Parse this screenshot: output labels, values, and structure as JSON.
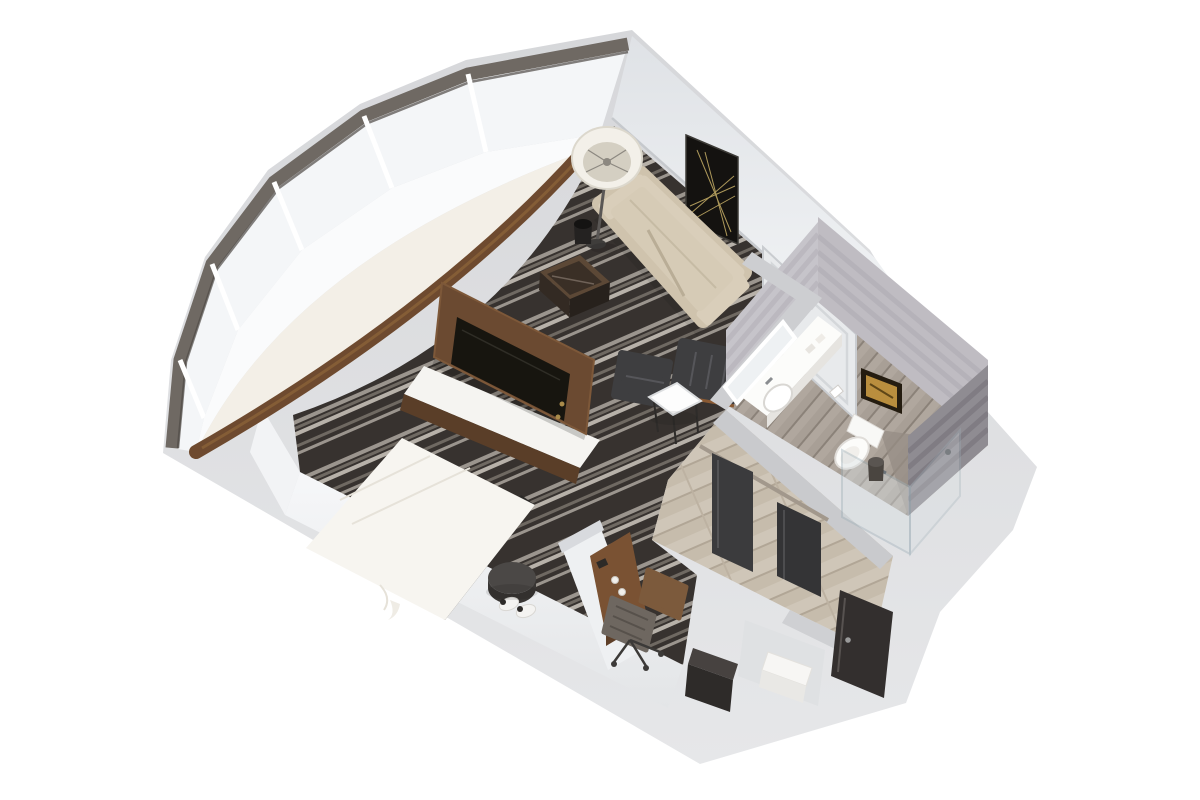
{
  "meta": {
    "type": "3d-floorplan-render",
    "view": "isometric-cutaway-dollhouse",
    "description": "3D cutaway floor plan render of a hotel studio suite with a curved faceted window wall, striped carpet, king bed, leaning TV media panel, beige sofa, lounge chair, work desk, entry hallway with closet, and a bathroom with vanity, toilet and glass shower."
  },
  "palette": {
    "background": "#ffffff",
    "wall_top": "#d3d4d7",
    "wall_top_dark": "#c6c7cb",
    "wall_inner": "#e9ebee",
    "wall_inner_bright": "#f4f5f7",
    "baseboard_shadow": "#c6c9cd",
    "glass": "#f4f6f8",
    "transom": "#6f6963",
    "mullion": "#ffffff",
    "sill_wall": "#fafbfc",
    "carpet_base": "#37322f",
    "carpet_stripe_light": "#9b958e",
    "carpet_stripe_mid": "#6f6962",
    "carpet_stripe_pale": "#b7b1a9",
    "bench_wood": "#6e4a2f",
    "bench_cushion": "#f3efe7",
    "bed_linen": "#f7f5f0",
    "bed_platform": "#2c2a28",
    "stool_dark": "#4b4846",
    "slipper_white": "#f4f3f1",
    "tv_wood": "#6b4a31",
    "tv_screen": "#17150f",
    "console_top": "#f5f4f1",
    "console_base": "#5a3e28",
    "cube_top": "#3a2f26",
    "cube_wood": "#5c4836",
    "sofa_base": "#cfc3ad",
    "sofa_cushion": "#d6cbb6",
    "sofa_back": "#d9ceba",
    "sofa_shadow": "#b9ad96",
    "lamp_shade": "#f3f0e9",
    "lamp_inner": "#d4cfc2",
    "bin_dark": "#242221",
    "art_black": "#141210",
    "art_gold": "#b98e3e",
    "leather_dark": "#3e3e40",
    "side_table_white": "#fdfdfd",
    "desk_wood": "#7a5233",
    "chair_seat": "#6e6760",
    "chair_back": "#7c5a3c",
    "hall_wood": "#cfc6b8",
    "bath_floor": "#a89f96",
    "bath_tile": "#c6c4ca",
    "bath_tile_dark": "#8f8c92",
    "fixture_white": "#fcfcfa",
    "shower_glass": "#d7dee1",
    "closet_door": "#3b3b3d",
    "entry_door": "#332f2e",
    "cabinet_dark": "#2e2b29",
    "partition_white": "#eef0f2"
  },
  "rooms": [
    {
      "name": "sleeping-living-area",
      "floor": "striped-carpet",
      "furniture": [
        "curved-window-seat",
        "king-bed",
        "round-stool",
        "slippers",
        "tv-panel",
        "media-console",
        "cube-side-table",
        "sofa",
        "floor-lamp",
        "wall-art",
        "waste-bin",
        "lounge-chair",
        "ottoman",
        "white-side-table",
        "work-desk",
        "desk-chair"
      ]
    },
    {
      "name": "bathroom",
      "floor": "wood-look-tile",
      "furniture": [
        "vanity-counter",
        "sink",
        "leaning-mirror",
        "toilet",
        "framed-art",
        "glass-shower",
        "waste-bin"
      ]
    },
    {
      "name": "entry-hallway",
      "floor": "light-wood-tile",
      "furniture": [
        "closet-sliding-doors",
        "minibar-cabinet",
        "luggage-bench",
        "entry-door"
      ]
    }
  ],
  "architecture": {
    "window_wall": "curved-faceted-glazing-with-dark-transom",
    "walls": "white-cutaway",
    "connecting_door_on_right_wall": true
  }
}
